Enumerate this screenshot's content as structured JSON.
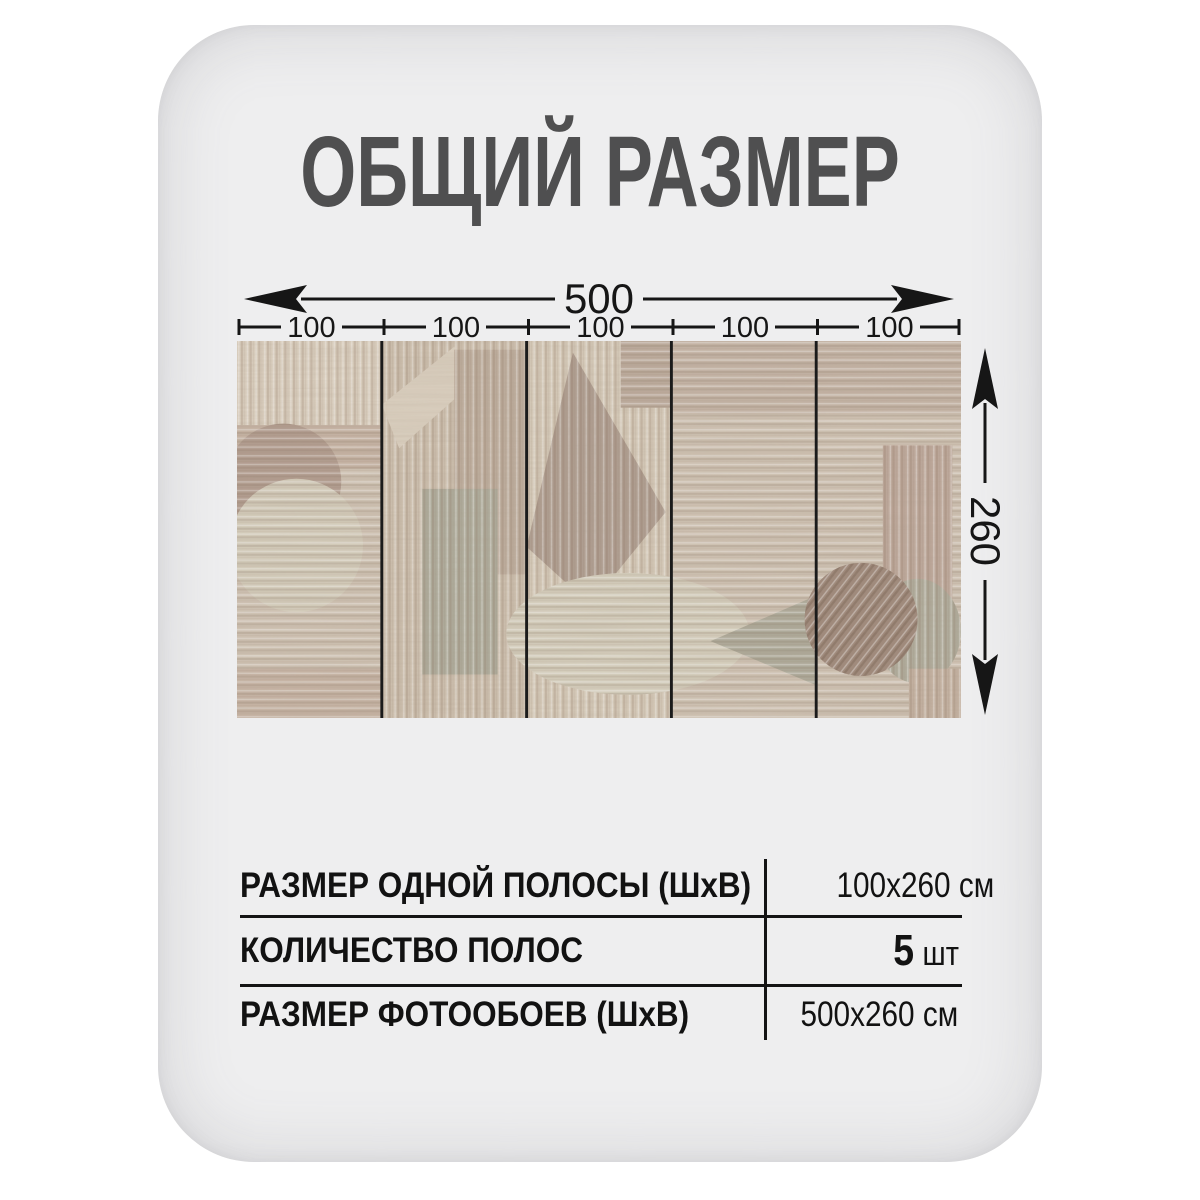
{
  "title": "ОБЩИЙ РАЗМЕР",
  "diagram": {
    "total_width": "500",
    "height": "260",
    "strip_labels": [
      "100",
      "100",
      "100",
      "100",
      "100"
    ],
    "strips_count": 5
  },
  "wallpaper": {
    "description": "wood-texture geometric collage preview, 5 strips",
    "palette": {
      "base": "#d2c6b7",
      "light_top": "#ddd2c2",
      "panel_light": "#d8cdbc",
      "band": "#c8b6a7",
      "circle_dark": "#b49f92",
      "circle_light": "#d7d0bf",
      "sage": "#b0ae9e",
      "triangle": "#b1a093",
      "dark_circle": "#9f897b",
      "divider": "#1b1b1b"
    }
  },
  "table": {
    "rows": [
      {
        "label": "РАЗМЕР ОДНОЙ ПОЛОСЫ (ШхВ)",
        "value": "100х260 см"
      },
      {
        "label": "КОЛИЧЕСТВО ПОЛОС",
        "value": "5",
        "unit": "шт"
      },
      {
        "label": "РАЗМЕР ФОТООБОЕВ (ШхВ)",
        "value": "500х260 см"
      }
    ]
  },
  "colors": {
    "page_bg": "#ffffff",
    "card_bg": "#eeeeef",
    "title": "#4f4f50",
    "line": "#161616",
    "text": "#121212"
  }
}
